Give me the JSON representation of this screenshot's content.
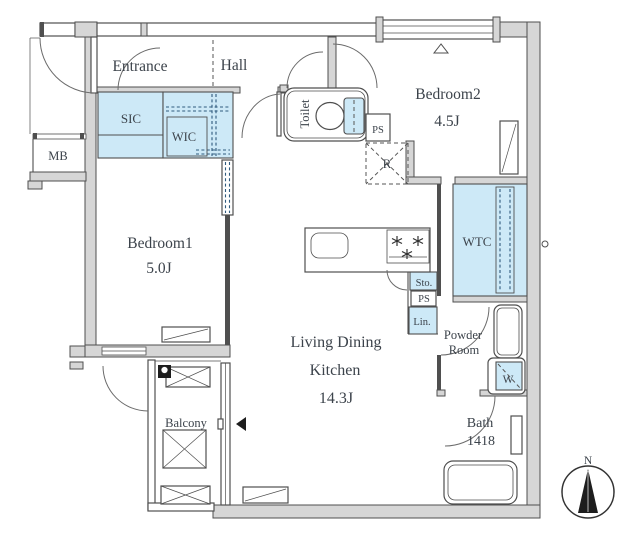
{
  "title": "Apartment floor plan",
  "labels": {
    "entrance": "Entrance",
    "hall": "Hall",
    "sic": "SIC",
    "wic": "WIC",
    "mb": "MB",
    "toilet": "Toilet",
    "ps_upper": "PS",
    "refrigerator_space": "R",
    "bedroom2_name": "Bedroom2",
    "bedroom2_size": "4.5J",
    "wtc": "WTC",
    "storage": "Sto.",
    "ps_lower": "PS",
    "linen": "Lin.",
    "powder_line1": "Powder",
    "powder_line2": "Room",
    "washer": "W",
    "bath_name": "Bath",
    "bath_size": "1418",
    "bedroom1_name": "Bedroom1",
    "bedroom1_size": "5.0J",
    "ldk_line1": "Living Dining",
    "ldk_line2": "Kitchen",
    "ldk_size": "14.3J",
    "balcony": "Balcony",
    "compass_north": "N"
  },
  "colors": {
    "accent_blue": "#cde9f7",
    "wall_gray": "#d6d6d6",
    "line": "#4f4f4f",
    "text": "#3c434b"
  }
}
